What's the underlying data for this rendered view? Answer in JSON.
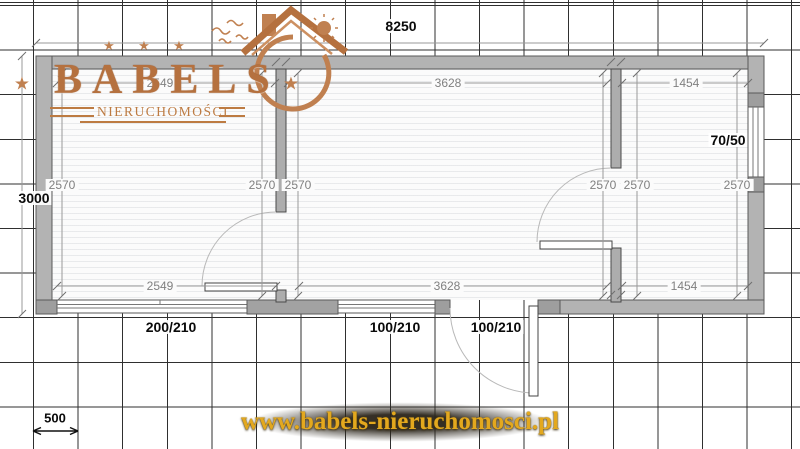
{
  "branding": {
    "name": "BABELS",
    "subtitle": "NIERUCHOMOŚCI",
    "website": "www.babels-nieruchomosci.pl"
  },
  "icons": {
    "star": "★"
  },
  "plan": {
    "overall": {
      "width": "8250",
      "height": "3000"
    },
    "scale_bar": "500",
    "rooms": {
      "left": {
        "width_top": "2549",
        "width_bottom": "2549",
        "height_left": "2570",
        "height_right": "2570"
      },
      "middle": {
        "width_top": "3628",
        "width_bottom": "3628",
        "height_left": "2570",
        "height_right": "2570"
      },
      "right": {
        "width_top": "1454",
        "width_bottom": "1454",
        "height_left": "2570",
        "height_right": "2570"
      }
    },
    "openings": {
      "window_left": "200/210",
      "window_middle": "100/210",
      "door_entrance": "100/210",
      "window_right": "70/50"
    }
  },
  "colors": {
    "wall": "#b3b3b3",
    "jamb": "#9e9e9e",
    "copper": "#b5713f",
    "gold": "#e3a81e",
    "dimension_text": "#808080"
  }
}
